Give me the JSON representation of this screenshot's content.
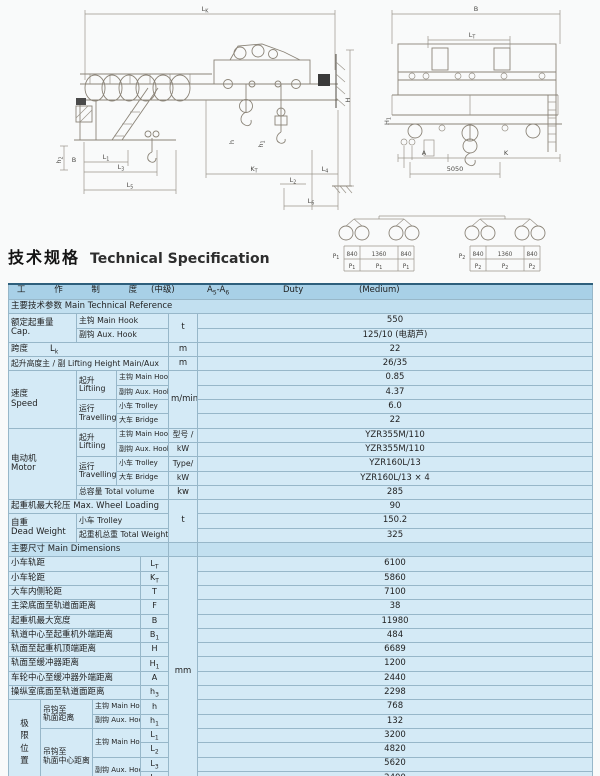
{
  "page": {
    "title_zh": "技术规格",
    "title_en": "Technical Specification"
  },
  "drawing": {
    "side": {
      "lk": {
        "l": "L",
        "s": "K"
      },
      "h": "H",
      "h2": {
        "l": "h",
        "s": "2"
      },
      "b_left": "B",
      "l1": {
        "l": "L",
        "s": "1"
      },
      "l3": {
        "l": "L",
        "s": "3"
      },
      "l5": {
        "l": "L",
        "s": "5"
      },
      "kt": {
        "l": "K",
        "s": "T"
      },
      "l2": {
        "l": "L",
        "s": "2"
      },
      "l4": {
        "l": "L",
        "s": "4"
      },
      "l6": {
        "l": "L",
        "s": "6"
      },
      "ha": {
        "l": "h",
        "s": ""
      },
      "hb": {
        "l": "h",
        "s": "1"
      }
    },
    "end": {
      "b": "B",
      "lt": {
        "l": "L",
        "s": "T"
      },
      "h1": {
        "l": "H",
        "s": "1"
      },
      "a": "A",
      "k": "K",
      "gauge": "5050"
    },
    "wheels": {
      "p1l": "P",
      "p1s": "1",
      "p2l": "P",
      "p2s": "2",
      "d840a": "840",
      "d1360": "1360",
      "d840b": "840"
    }
  },
  "table": {
    "header": {
      "work_system": "工 作 制 度",
      "grade": "(中级)",
      "class_a": "A",
      "class_a_sub": "5",
      "class_b": "-A",
      "class_b_sub": "6",
      "duty": "Duty",
      "medium": "(Medium)"
    },
    "section1": "主要技术参数 Main Technical Reference",
    "cap": {
      "zh": "额定起重量",
      "en": "Cap.",
      "main": "主钩 Main Hook",
      "aux": "副钩 Aux. Hook",
      "unit": "t",
      "main_val": "550",
      "aux_val": "125/10 (电葫芦)"
    },
    "span": {
      "zh": "跨度",
      "sym": {
        "l": "L",
        "s": "k"
      },
      "unit": "m",
      "val": "22"
    },
    "lifting_height": {
      "label": "起升高度主 / 副 Lifting Height Main/Aux",
      "unit": "m",
      "val": "26/35"
    },
    "speed": {
      "zh": "速度",
      "en": "Speed",
      "lifting_zh": "起升",
      "lifting_en": "Liftiing",
      "travel_zh": "运行",
      "travel_en": "Travelling",
      "main": "主钩 Main Hook",
      "aux": "副钩 Aux. Hook",
      "trolley": "小车 Trolley",
      "bridge": "大车 Bridge",
      "unit": "m/min",
      "main_val": "0.85",
      "aux_val": "4.37",
      "trolley_val": "6.0",
      "bridge_val": "22"
    },
    "motor": {
      "zh": "电动机",
      "en": "Motor",
      "lifting_zh": "起升",
      "lifting_en": "Liftiing",
      "travel_zh": "运行",
      "travel_en": "Travelling",
      "main": "主钩 Main Hook",
      "aux": "副钩 Aux. Hook",
      "trolley": "小车 Trolley",
      "bridge": "大车 Bridge",
      "unit1": "型号 /",
      "unit2": "kW",
      "unit3": "Type/",
      "unit4": "kW",
      "main_val": "YZR355M/110",
      "aux_val": "YZR355M/110",
      "trolley_val": "YZR160L/13",
      "bridge_val": "YZR160L/13 × 4",
      "total_label": "总容量 Total volume",
      "total_unit": "kw",
      "total_val": "285"
    },
    "wheel_loading": {
      "label": "起重机最大轮压 Max. Wheel Loading",
      "unit": "t",
      "val": "90"
    },
    "dead_weight": {
      "zh": "自重",
      "en": "Dead Weight",
      "trolley": "小车 Trolley",
      "total": "起重机总重 Total Weight",
      "trolley_val": "150.2",
      "total_val": "325"
    },
    "section2": "主要尺寸 Main Dimensions",
    "dims": {
      "unit": "mm",
      "rows": [
        {
          "label": "小车轨距",
          "sym": "L",
          "sub": "T",
          "val": "6100"
        },
        {
          "label": "小车轮距",
          "sym": "K",
          "sub": "T",
          "val": "5860"
        },
        {
          "label": "大车内侧轮距",
          "sym": "T",
          "sub": "",
          "val": "7100"
        },
        {
          "label": "主梁底面至轨道面距离",
          "sym": "F",
          "sub": "",
          "val": "38"
        },
        {
          "label": "起重机最大宽度",
          "sym": "B",
          "sub": "",
          "val": "11980"
        },
        {
          "label": "轨道中心至起重机外端距离",
          "sym": "B",
          "sub": "1",
          "val": "484"
        },
        {
          "label": "轨面至起重机顶端距离",
          "sym": "H",
          "sub": "",
          "val": "6689"
        },
        {
          "label": "轨面至缓冲器距离",
          "sym": "H",
          "sub": "1",
          "val": "1200"
        },
        {
          "label": "车轮中心至缓冲器外端距离",
          "sym": "A",
          "sub": "",
          "val": "2440"
        },
        {
          "label": "操纵室底面至轨道面距离",
          "sym": "h",
          "sub": "3",
          "val": "2298"
        }
      ]
    },
    "limits": {
      "vert": [
        "极",
        "限",
        "位",
        "置"
      ],
      "hook_rail1": "吊钩至",
      "hook_rail2": "轨面距离",
      "hook_center1": "吊钩至",
      "hook_center2": "轨面中心距离",
      "main": "主钩 Main Hook",
      "aux": "副钩 Aux. Hook",
      "rows": [
        {
          "sym": "h",
          "sub": "",
          "val": "768"
        },
        {
          "sym": "h",
          "sub": "1",
          "val": "132"
        },
        {
          "sym": "L",
          "sub": "1",
          "val": "3200"
        },
        {
          "sym": "L",
          "sub": "2",
          "val": "4820"
        },
        {
          "sym": "L",
          "sub": "3",
          "val": "5620"
        },
        {
          "sym": "L",
          "sub": "4",
          "val": "2400"
        }
      ]
    },
    "rail": {
      "label": "荐用大车轨道型号 Steel Rail Recommended",
      "val": "QU100"
    }
  }
}
